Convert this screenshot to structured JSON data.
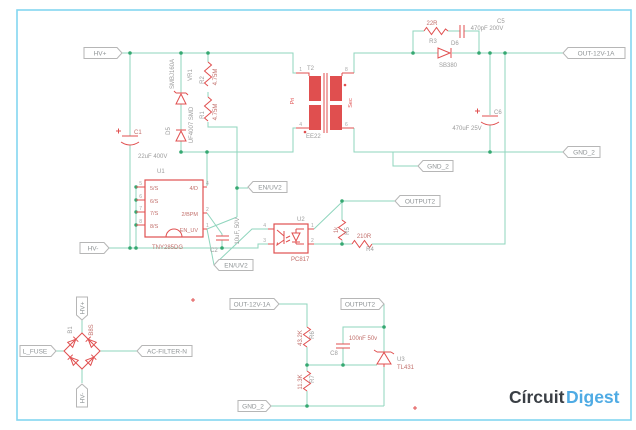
{
  "nets": {
    "hv_plus": "HV+",
    "hv_minus": "HV-",
    "en_uv2": "EN/UV2",
    "gnd_2": "GND_2",
    "output2": "OUTPUT2",
    "out_12v": "OUT-12V-1A",
    "l_fuse": "L_FUSE",
    "ac_filter_n": "AC-FILTER-N"
  },
  "parts": {
    "c1": {
      "name": "C1",
      "value": "22uF 400V"
    },
    "vr1": {
      "name": "VR1",
      "value": "SMBJ160A"
    },
    "d5": {
      "name": "D5",
      "value": "UF4007 SMD"
    },
    "r2": {
      "name": "R2",
      "value": "4.75M"
    },
    "r1": {
      "name": "R1",
      "value": "4.75M"
    },
    "u1": {
      "name": "U1",
      "value": "TNY285DG",
      "pin5": "5/S",
      "pin6": "6/S",
      "pin7": "7/S",
      "pin8": "8/S",
      "pin4": "4/D",
      "pin2": "2/BPM",
      "pin1": "EN_UV",
      "n5": "5",
      "n6": "6",
      "n7": "7",
      "n8": "8",
      "n4": "4",
      "n2": "2",
      "n1": "1"
    },
    "c2": {
      "name": "C2",
      "value": "10uF, 50V"
    },
    "t2": {
      "name": "T2",
      "value": "EE22",
      "pri": "Pri",
      "sec": "Sec",
      "p1": "1",
      "p4": "4",
      "p8": "8",
      "p6": "6"
    },
    "r3": {
      "name": "R3",
      "value": "22R"
    },
    "c5": {
      "name": "C5",
      "value": "470pF 200V"
    },
    "d6": {
      "name": "D6",
      "value": "SB380"
    },
    "c6": {
      "name": "C6",
      "value": "470uF 25V"
    },
    "u2": {
      "name": "U2",
      "value": "PC817",
      "n1": "1",
      "n2": "2",
      "n3": "3",
      "n4": "4"
    },
    "r5": {
      "name": "R5",
      "value": "1k"
    },
    "r4": {
      "name": "R4",
      "value": "210R"
    },
    "b1": {
      "name": "B1",
      "value": "B8S"
    },
    "r6": {
      "name": "R6",
      "value": "43.2K"
    },
    "r7": {
      "name": "R7",
      "value": "11.3K"
    },
    "c8": {
      "name": "C8",
      "value": "100nF 50v"
    },
    "u3": {
      "name": "U3",
      "value": "TL431"
    }
  },
  "logo": {
    "circuit": "Círcuit",
    "digest": "Digest"
  },
  "colors": {
    "wire": "#8fd5bd",
    "junction": "#35a871",
    "component": "#e04f4f",
    "net_text": "#8f9496",
    "border": "#84d6f0",
    "logo_dark": "#3a3f45",
    "logo_blue": "#4fabe4"
  }
}
